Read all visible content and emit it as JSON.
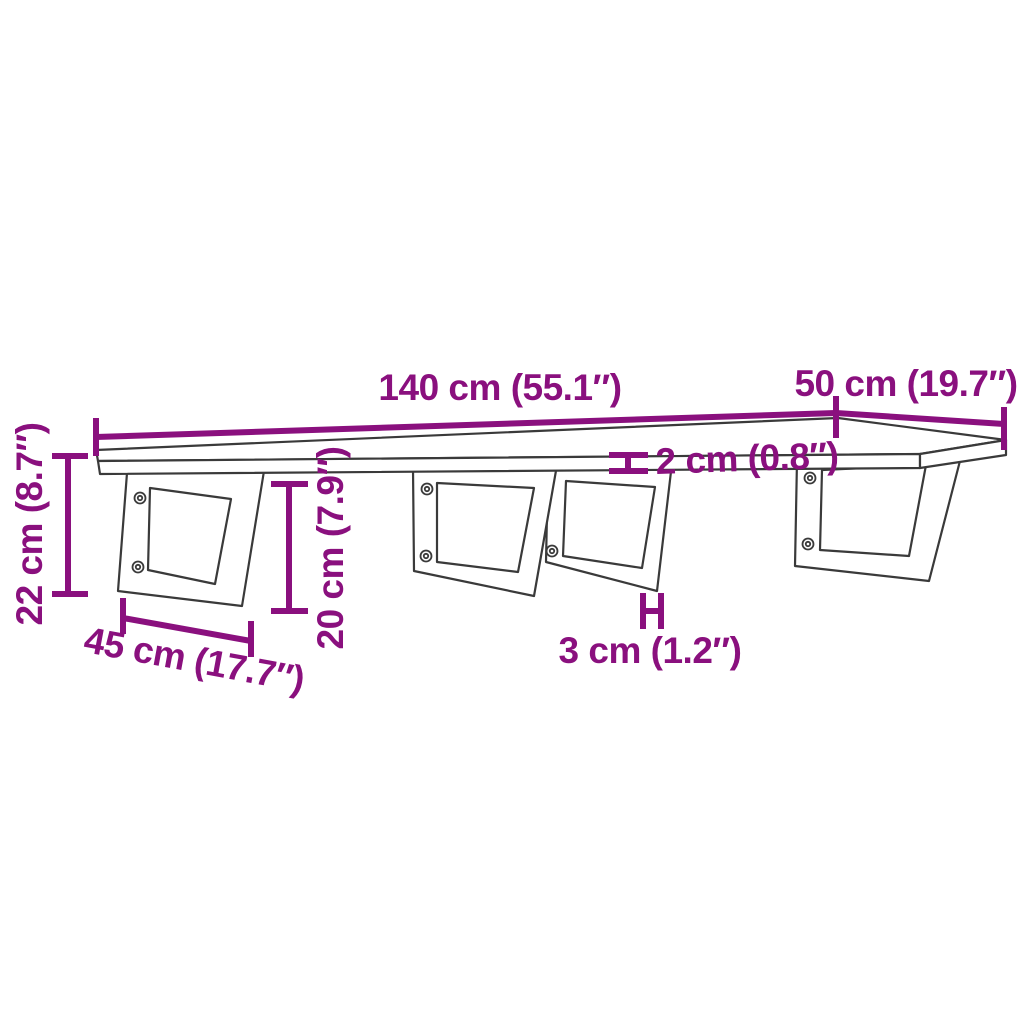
{
  "diagram": {
    "kind": "furniture-dimension-diagram",
    "background_color": "#ffffff",
    "accent_color": "#8a107e",
    "line_color": "#3a3a3a",
    "scene": {
      "object": "wall-mounted shelf board on four trapezoid brackets",
      "bracket_count": 4,
      "visible_screw_holes": 7
    },
    "dimensions": {
      "board_width": {
        "label": "140 cm (55.1″)",
        "value_cm": 140,
        "value_in": 55.1
      },
      "board_depth": {
        "label": "50 cm (19.7″)",
        "value_cm": 50,
        "value_in": 19.7
      },
      "board_thickness": {
        "label": "2 cm (0.8″)",
        "value_cm": 2,
        "value_in": 0.8
      },
      "total_height": {
        "label": "22 cm (8.7″)",
        "value_cm": 22,
        "value_in": 8.7
      },
      "bracket_depth": {
        "label": "45 cm (17.7″)",
        "value_cm": 45,
        "value_in": 17.7
      },
      "bracket_height": {
        "label": "20 cm (7.9″)",
        "value_cm": 20,
        "value_in": 7.9
      },
      "bracket_thickness": {
        "label": "3 cm (1.2″)",
        "value_cm": 3,
        "value_in": 1.2
      }
    }
  }
}
